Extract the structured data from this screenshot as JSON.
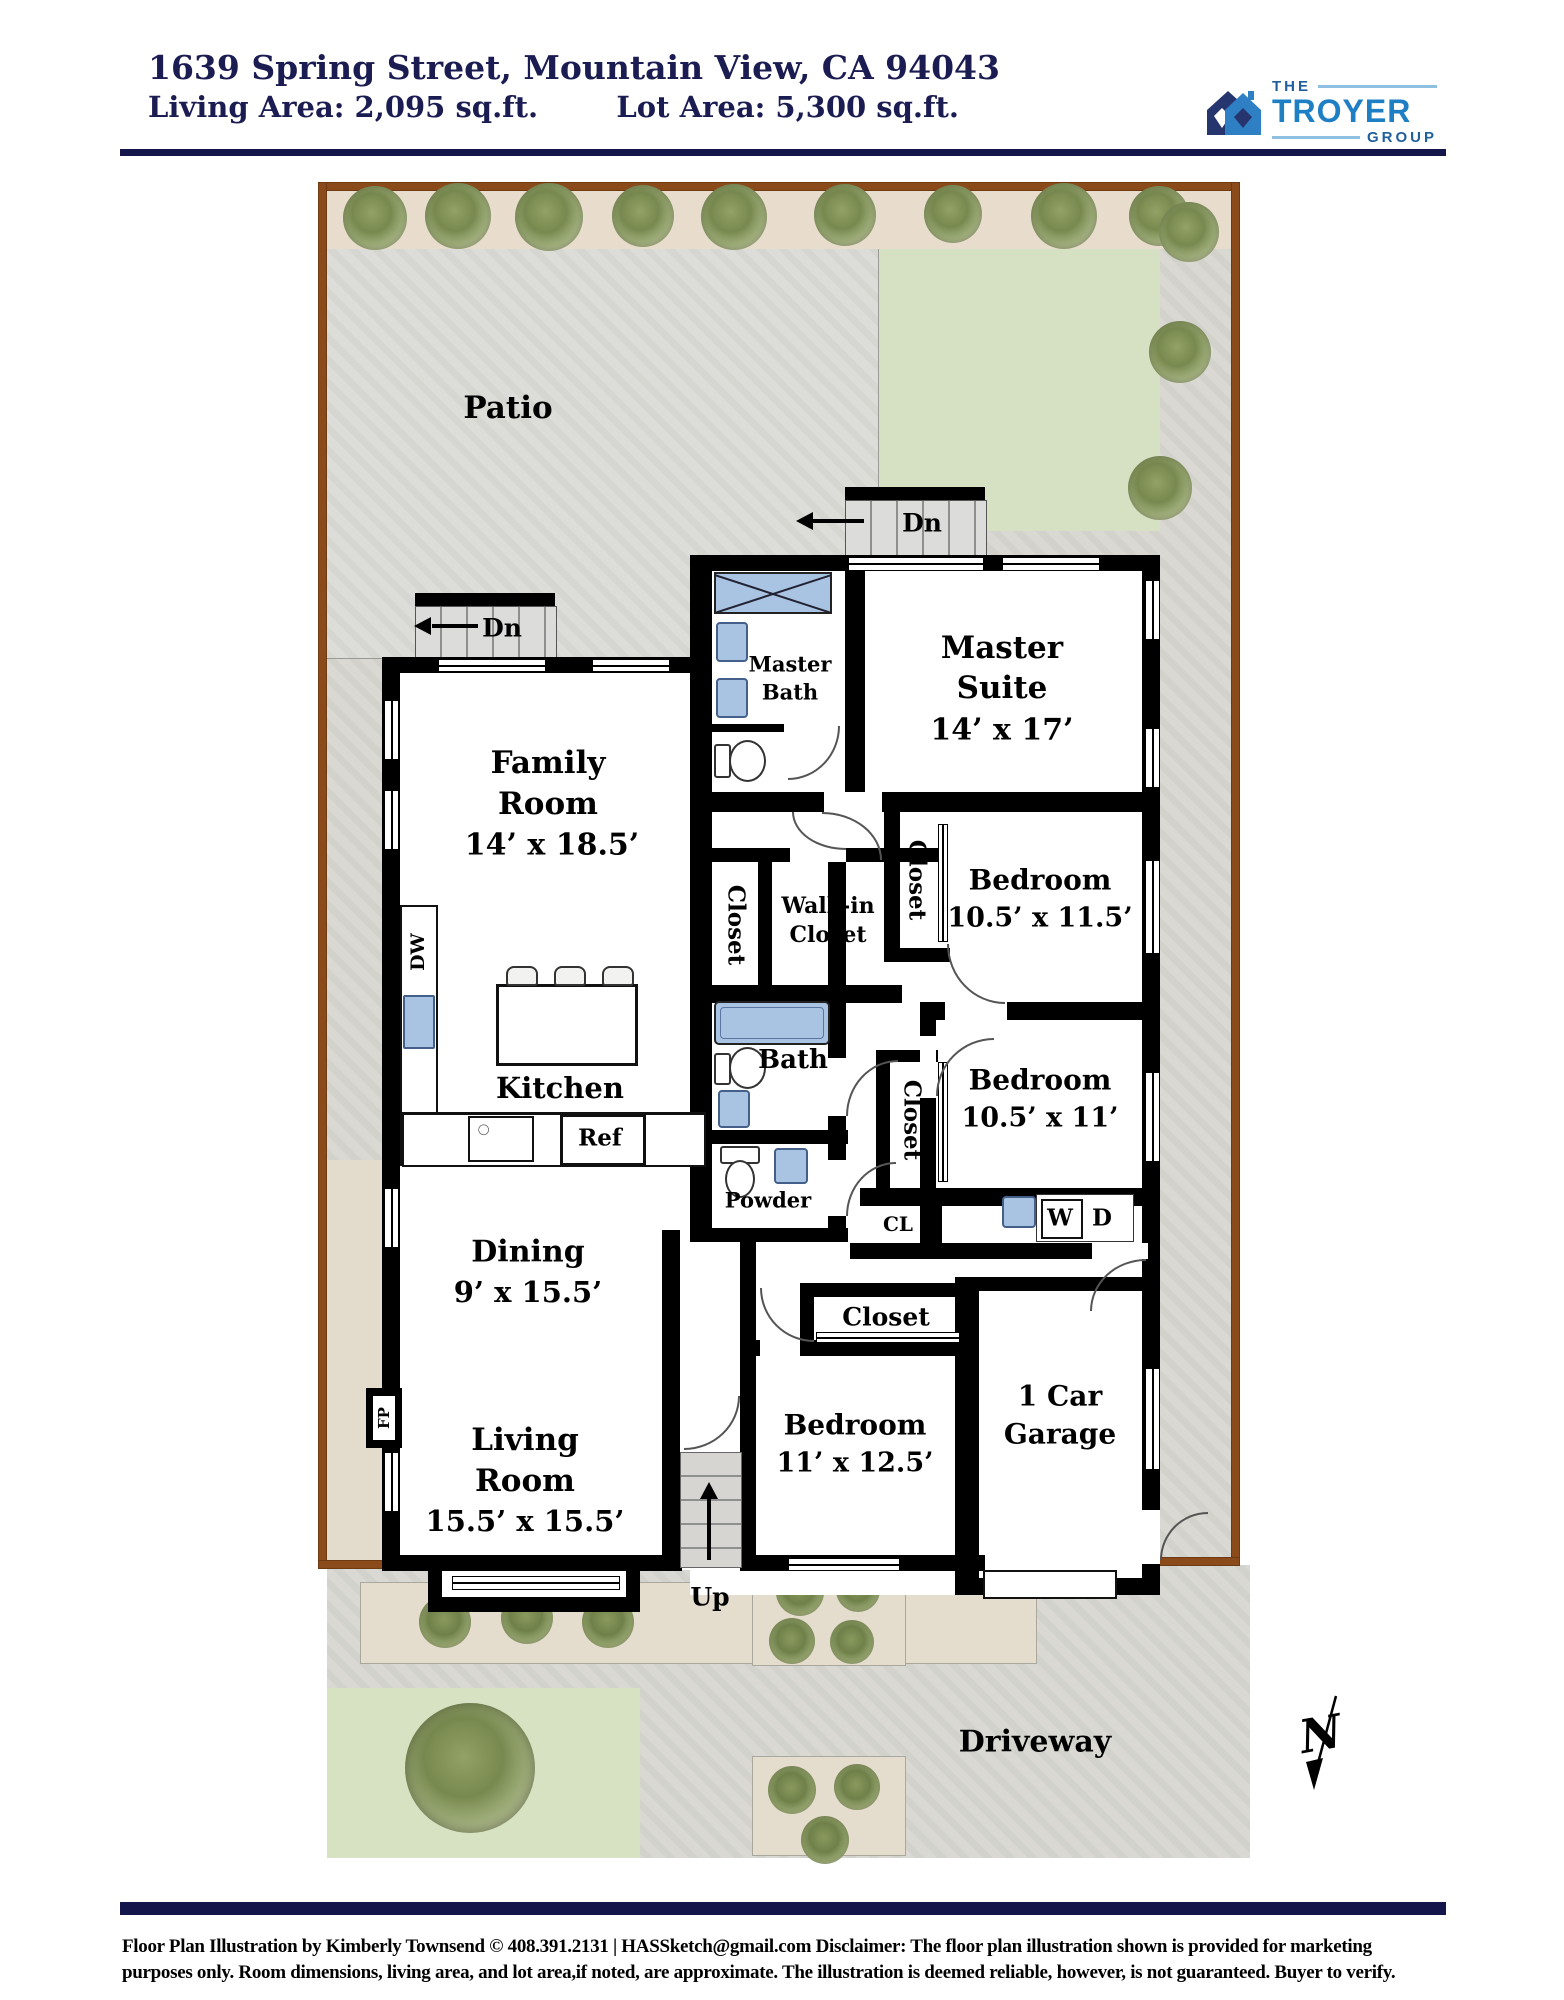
{
  "colors": {
    "header_navy": "#1b1c52",
    "logo_blue": "#1e7fc4",
    "logo_navy": "#27356e",
    "lot_line_brown": "#8a4a1a",
    "fixture_blue": "#a9c4e2",
    "lawn_green": "#d6e0c2",
    "patio_gray": "#dcddd8",
    "wall_black": "#000000"
  },
  "header": {
    "address": "1639 Spring Street, Mountain View, CA 94043",
    "living_area": "Living Area: 2,095 sq.ft.",
    "lot_area": "Lot Area: 5,300 sq.ft.",
    "logo": {
      "the": "THE",
      "name": "TROYER",
      "group": "GROUP"
    }
  },
  "site": {
    "patio": "Patio",
    "driveway": "Driveway",
    "north": "N"
  },
  "stairs": {
    "down": "Dn",
    "up": "Up"
  },
  "rooms": {
    "family": {
      "l1": "Family",
      "l2": "Room",
      "dims": "14’ x 18.5’"
    },
    "master": {
      "l1": "Master",
      "l2": "Suite",
      "dims": "14’ x 17’"
    },
    "master_bath": {
      "l1": "Master",
      "l2": "Bath"
    },
    "walkin": {
      "l1": "Walk-in",
      "l2": "Closet"
    },
    "bed1": {
      "name": "Bedroom",
      "dims": "10.5’ x 11.5’"
    },
    "bed2": {
      "name": "Bedroom",
      "dims": "10.5’ x 11’"
    },
    "bed3": {
      "name": "Bedroom",
      "dims": "11’ x 12.5’"
    },
    "living": {
      "l1": "Living",
      "l2": "Room",
      "dims": "15.5’ x 15.5’"
    },
    "dining": {
      "name": "Dining",
      "dims": "9’ x 15.5’"
    },
    "kitchen": {
      "name": "Kitchen"
    },
    "garage": {
      "l1": "1 Car",
      "l2": "Garage"
    },
    "bath": {
      "name": "Bath"
    },
    "powder": {
      "name": "Powder"
    },
    "closet": {
      "name": "Closet"
    },
    "cl": {
      "name": "CL"
    }
  },
  "fixtures": {
    "dw": "DW",
    "ref": "Ref",
    "fp": "FP",
    "washer": "W",
    "dryer": "D"
  },
  "footer": {
    "line1": "Floor Plan Illustration by Kimberly Townsend ©  408.391.2131    |    HASSketch@gmail.com      Disclaimer: The floor plan illustration shown is provided for marketing",
    "line2": "purposes only. Room dimensions, living area, and lot area,if noted, are approximate. The illustration is deemed reliable, however, is not guaranteed.  Buyer to verify."
  }
}
